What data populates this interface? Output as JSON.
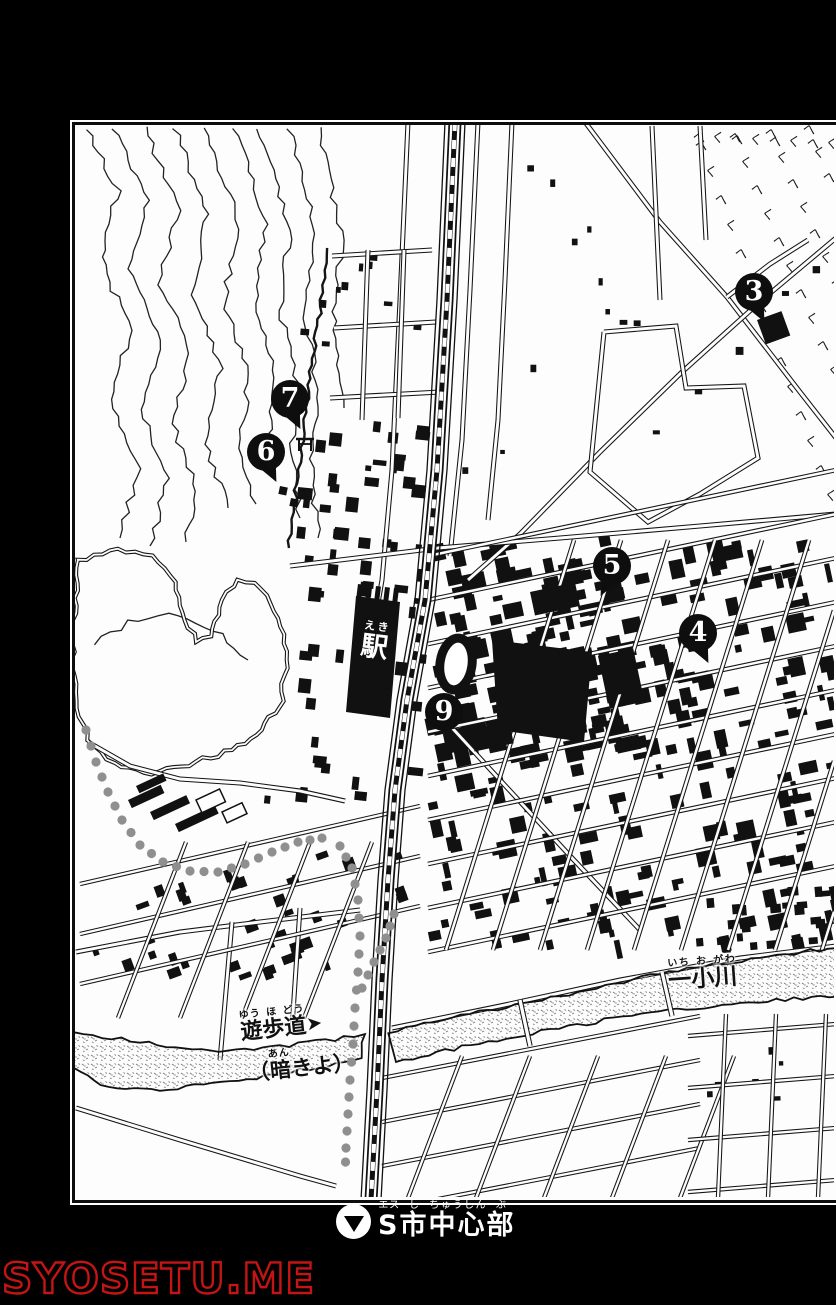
{
  "page": {
    "background": "#000000",
    "panel_background": "#fdfdfd",
    "ink": "#111111"
  },
  "map": {
    "markers": [
      {
        "num": "3",
        "x": 754,
        "y": 292,
        "pointer": "down-right"
      },
      {
        "num": "7",
        "x": 290,
        "y": 399,
        "pointer": "down-right"
      },
      {
        "num": "6",
        "x": 266,
        "y": 452,
        "pointer": "down-right"
      },
      {
        "num": "5",
        "x": 612,
        "y": 566,
        "pointer": "down-left"
      },
      {
        "num": "4",
        "x": 698,
        "y": 633,
        "pointer": "down-right"
      },
      {
        "num": "9",
        "x": 444,
        "y": 712,
        "pointer": "none"
      }
    ],
    "labels": {
      "station": {
        "ruby": [
          {
            "b": "駅",
            "rt": "えき"
          }
        ]
      },
      "river": {
        "ruby": [
          {
            "b": "一",
            "rt": "いち"
          },
          {
            "b": "小",
            "rt": "お"
          },
          {
            "b": "川",
            "rt": "がわ"
          }
        ]
      },
      "promenade": {
        "ruby": [
          {
            "b": "遊",
            "rt": "ゆう"
          },
          {
            "b": "歩",
            "rt": "ほ"
          },
          {
            "b": "道",
            "rt": "どう"
          }
        ],
        "arrow": "➤"
      },
      "culvert": {
        "ruby": [
          {
            "b": "（",
            "rt": ""
          },
          {
            "b": "暗",
            "rt": "あん"
          },
          {
            "b": "きよ）",
            "rt": ""
          }
        ]
      }
    },
    "symbols": {
      "shrine": "torii-icon",
      "promenade_trail": "dotted-line",
      "river_texture": "stipple"
    }
  },
  "caption": {
    "icon": "down-triangle-in-circle",
    "ruby": [
      {
        "b": "S",
        "rt": "エス"
      },
      {
        "b": "市",
        "rt": "し"
      },
      {
        "b": "中心",
        "rt": "ちゅうしん"
      },
      {
        "b": "部",
        "rt": "ぶ"
      }
    ]
  },
  "watermark": {
    "text": "SYOSETU.ME",
    "color": "#c41414"
  }
}
